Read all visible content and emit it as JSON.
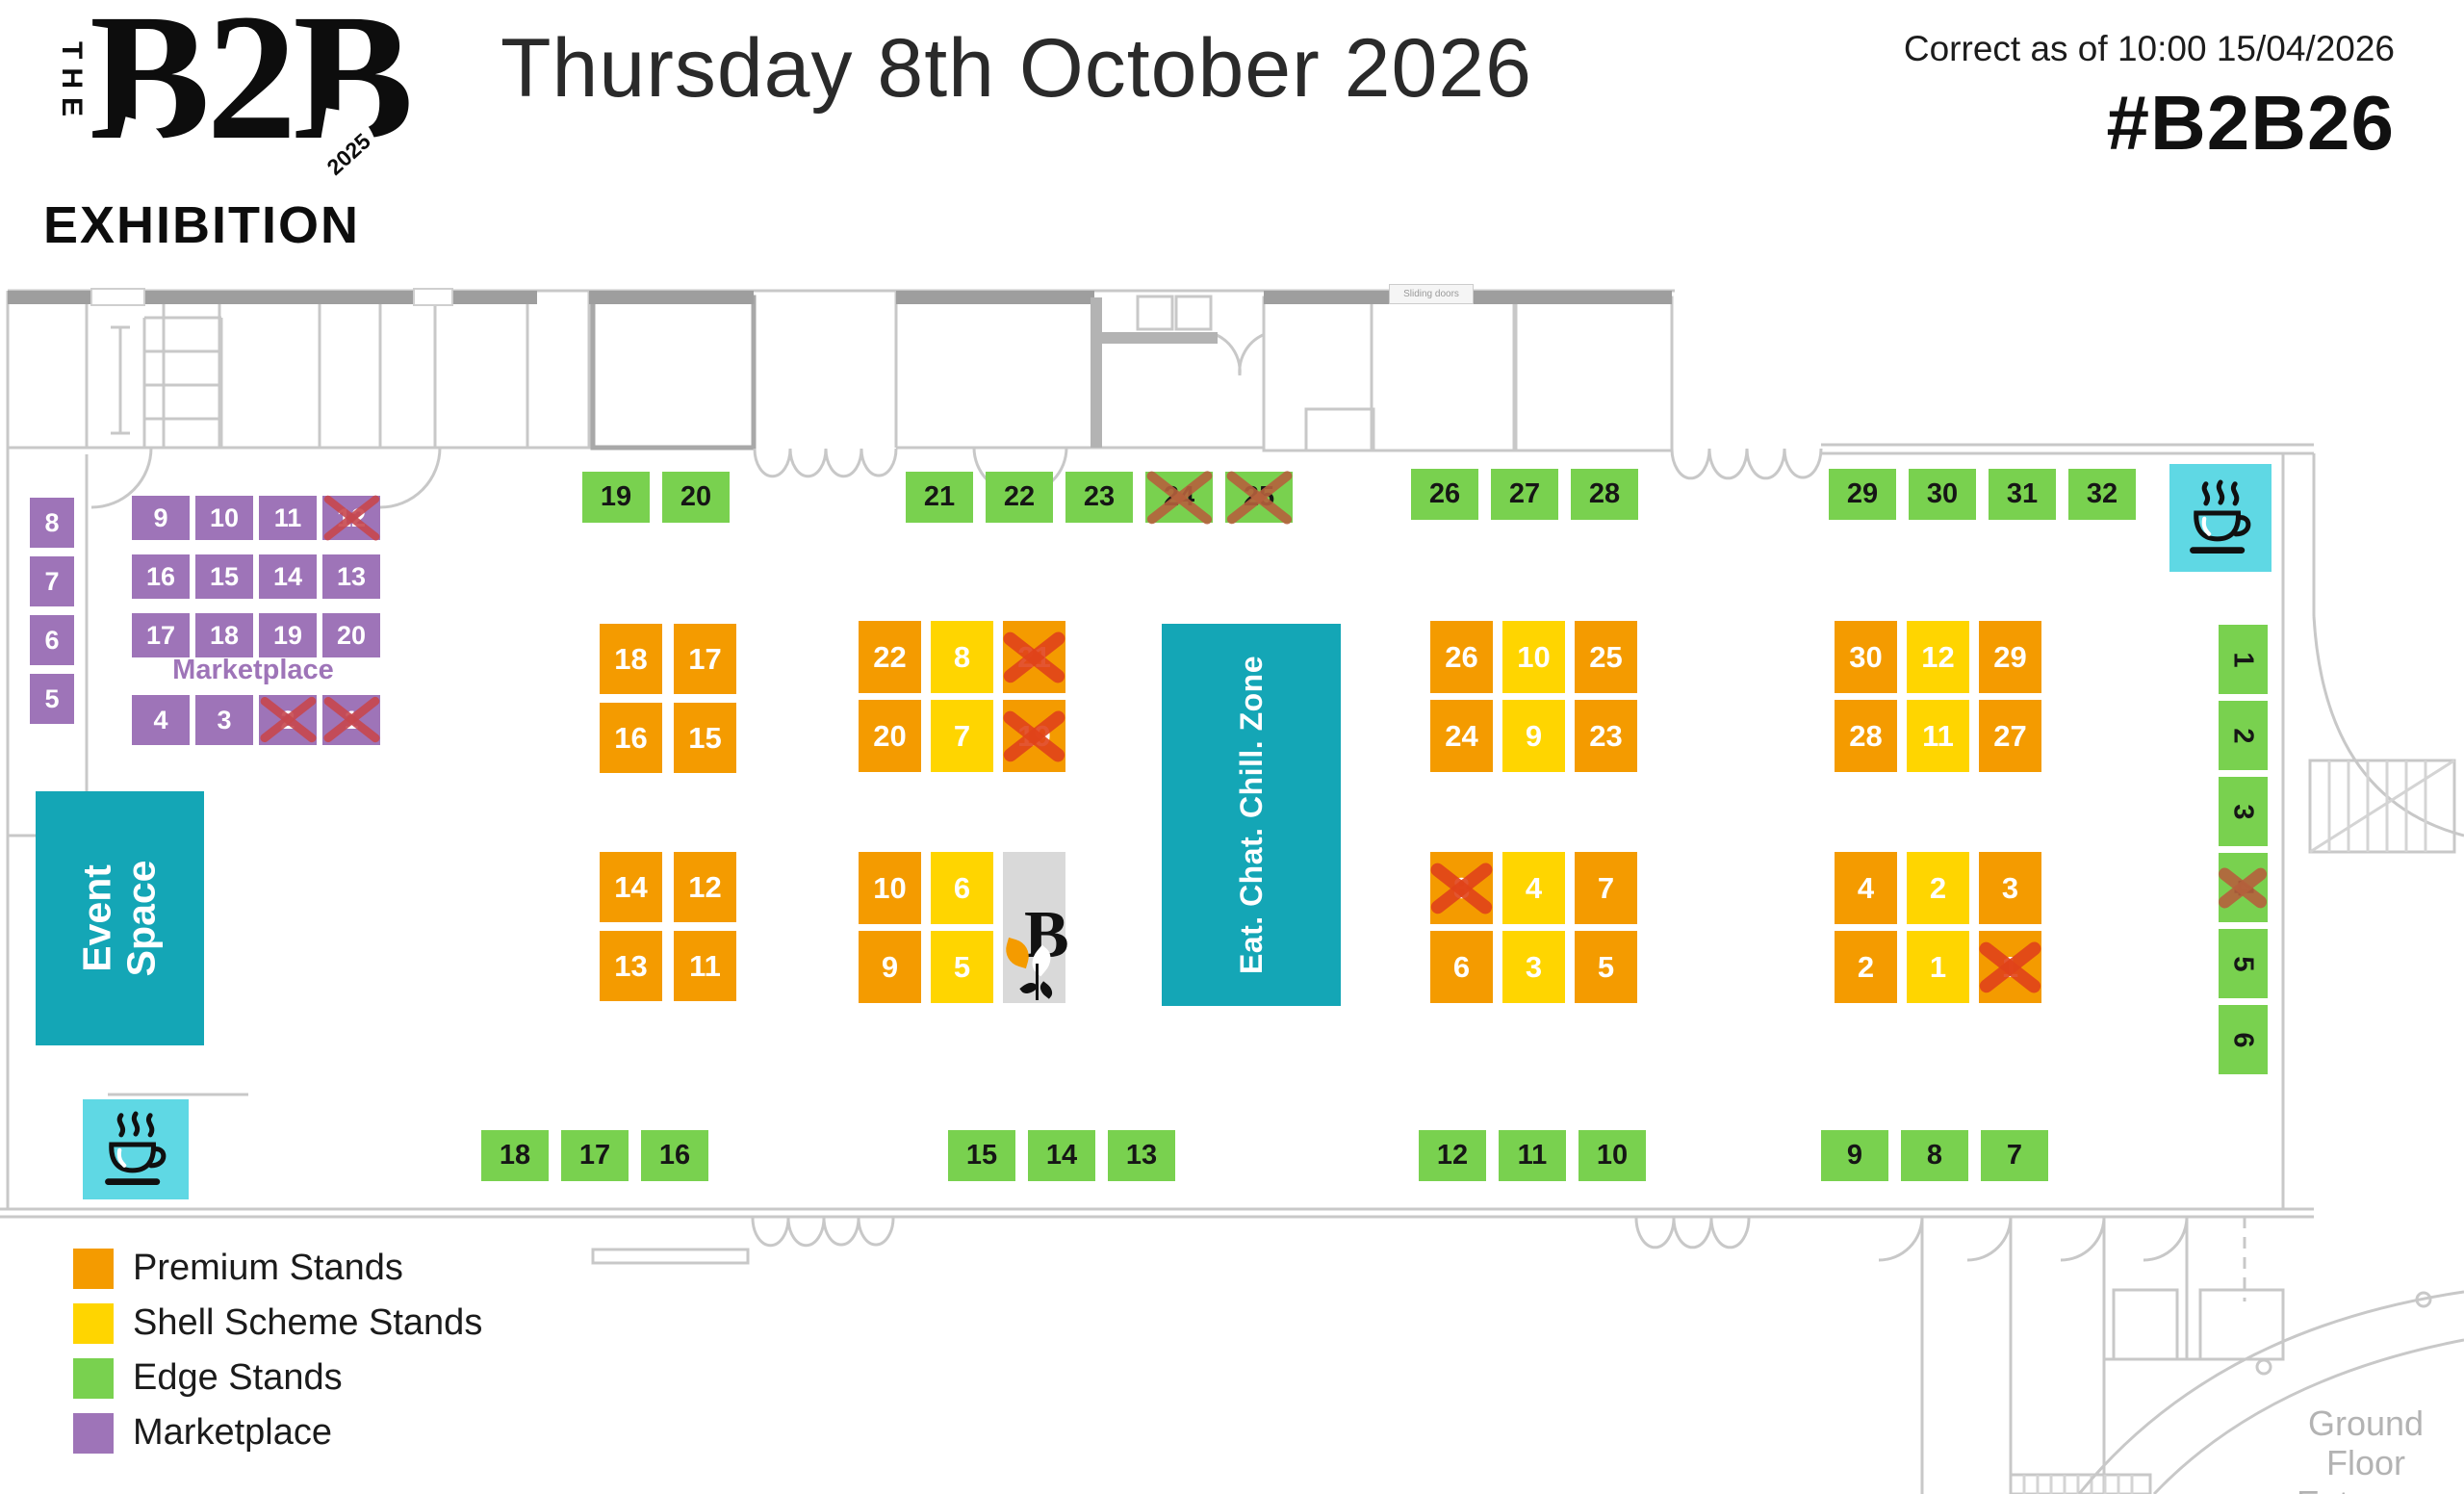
{
  "colors": {
    "premium": "#F49B00",
    "shell": "#FFD500",
    "edge": "#79D14F",
    "marketplace": "#9E74B8",
    "teal": "#14A6B6",
    "teal_light": "#5FD8E4",
    "cross_orange": "#E0421A",
    "cross_crimson": "#C7474E",
    "cross_brick": "#B5603C"
  },
  "header": {
    "logo_the": "THE",
    "logo_b2b": "B2B",
    "logo_year": "2025",
    "logo_exhibition": "EXHIBITION",
    "title": "Thursday 8th October 2026",
    "correct_as_of": "Correct as of 10:00 15/04/2026",
    "hashtag": "#B2B26"
  },
  "zones": {
    "event_space": "Event Space",
    "eat_chat_chill": "Eat. Chat. Chill. Zone",
    "marketplace_label": "Marketplace",
    "ground_floor_line1": "Ground Floor",
    "ground_floor_line2": "Entrance",
    "sliding_doors": "Sliding doors",
    "b_stand_letter": "B"
  },
  "legend": {
    "items": [
      {
        "label": "Premium Stands",
        "type": "p"
      },
      {
        "label": "Shell Scheme Stands",
        "type": "s"
      },
      {
        "label": "Edge Stands",
        "type": "e"
      },
      {
        "label": "Marketplace",
        "type": "m"
      }
    ]
  },
  "stands": {
    "marketplace_column": [
      [
        {
          "n": "8",
          "t": "m"
        }
      ],
      [
        {
          "n": "7",
          "t": "m"
        }
      ],
      [
        {
          "n": "6",
          "t": "m"
        }
      ],
      [
        {
          "n": "5",
          "t": "m"
        }
      ]
    ],
    "marketplace_grid": [
      [
        {
          "n": "9",
          "t": "m"
        },
        {
          "n": "10",
          "t": "m"
        },
        {
          "n": "11",
          "t": "m"
        },
        {
          "n": "12",
          "t": "m",
          "x": true
        }
      ],
      [
        {
          "n": "16",
          "t": "m"
        },
        {
          "n": "15",
          "t": "m"
        },
        {
          "n": "14",
          "t": "m"
        },
        {
          "n": "13",
          "t": "m"
        }
      ],
      [
        {
          "n": "17",
          "t": "m"
        },
        {
          "n": "18",
          "t": "m"
        },
        {
          "n": "19",
          "t": "m"
        },
        {
          "n": "20",
          "t": "m"
        }
      ]
    ],
    "marketplace_row4": [
      [
        {
          "n": "4",
          "t": "m"
        },
        {
          "n": "3",
          "t": "m"
        },
        {
          "n": "2",
          "t": "m",
          "x": true
        },
        {
          "n": "1",
          "t": "m",
          "x": true
        }
      ]
    ],
    "edge_top_a": [
      [
        {
          "n": "19",
          "t": "e"
        },
        {
          "n": "20",
          "t": "e"
        }
      ]
    ],
    "edge_top_b": [
      [
        {
          "n": "21",
          "t": "e"
        },
        {
          "n": "22",
          "t": "e"
        },
        {
          "n": "23",
          "t": "e"
        },
        {
          "n": "24",
          "t": "e",
          "x": true
        },
        {
          "n": "25",
          "t": "e",
          "x": true
        }
      ]
    ],
    "edge_top_c": [
      [
        {
          "n": "26",
          "t": "e"
        },
        {
          "n": "27",
          "t": "e"
        },
        {
          "n": "28",
          "t": "e"
        }
      ]
    ],
    "edge_top_d": [
      [
        {
          "n": "29",
          "t": "e"
        },
        {
          "n": "30",
          "t": "e"
        },
        {
          "n": "31",
          "t": "e"
        },
        {
          "n": "32",
          "t": "e"
        }
      ]
    ],
    "cluster_a_top": [
      [
        {
          "n": "18",
          "t": "p"
        },
        {
          "n": "17",
          "t": "p"
        }
      ],
      [
        {
          "n": "16",
          "t": "p"
        },
        {
          "n": "15",
          "t": "p"
        }
      ]
    ],
    "cluster_a_bottom": [
      [
        {
          "n": "14",
          "t": "p"
        },
        {
          "n": "12",
          "t": "p"
        }
      ],
      [
        {
          "n": "13",
          "t": "p"
        },
        {
          "n": "11",
          "t": "p"
        }
      ]
    ],
    "cluster_b_top": [
      [
        {
          "n": "22",
          "t": "p"
        },
        {
          "n": "8",
          "t": "s"
        },
        {
          "n": "21",
          "t": "p",
          "x": true
        }
      ],
      [
        {
          "n": "20",
          "t": "p"
        },
        {
          "n": "7",
          "t": "s"
        },
        {
          "n": "19",
          "t": "p",
          "x": true
        }
      ]
    ],
    "cluster_b_bottom": [
      [
        {
          "n": "10",
          "t": "p"
        },
        {
          "n": "6",
          "t": "s"
        }
      ],
      [
        {
          "n": "9",
          "t": "p"
        },
        {
          "n": "5",
          "t": "s"
        }
      ]
    ],
    "cluster_c_top": [
      [
        {
          "n": "26",
          "t": "p"
        },
        {
          "n": "10",
          "t": "s"
        },
        {
          "n": "25",
          "t": "p"
        }
      ],
      [
        {
          "n": "24",
          "t": "p"
        },
        {
          "n": "9",
          "t": "s"
        },
        {
          "n": "23",
          "t": "p"
        }
      ]
    ],
    "cluster_c_bottom": [
      [
        {
          "n": "8",
          "t": "p",
          "x": true
        },
        {
          "n": "4",
          "t": "s"
        },
        {
          "n": "7",
          "t": "p"
        }
      ],
      [
        {
          "n": "6",
          "t": "p"
        },
        {
          "n": "3",
          "t": "s"
        },
        {
          "n": "5",
          "t": "p"
        }
      ]
    ],
    "cluster_d_top": [
      [
        {
          "n": "30",
          "t": "p"
        },
        {
          "n": "12",
          "t": "s"
        },
        {
          "n": "29",
          "t": "p"
        }
      ],
      [
        {
          "n": "28",
          "t": "p"
        },
        {
          "n": "11",
          "t": "s"
        },
        {
          "n": "27",
          "t": "p"
        }
      ]
    ],
    "cluster_d_bottom": [
      [
        {
          "n": "4",
          "t": "p"
        },
        {
          "n": "2",
          "t": "s"
        },
        {
          "n": "3",
          "t": "p"
        }
      ],
      [
        {
          "n": "2",
          "t": "p"
        },
        {
          "n": "1",
          "t": "s"
        },
        {
          "n": "1",
          "t": "p",
          "x": true
        }
      ]
    ],
    "edge_right_column": [
      [
        {
          "n": "1",
          "t": "e"
        }
      ],
      [
        {
          "n": "2",
          "t": "e"
        }
      ],
      [
        {
          "n": "3",
          "t": "e"
        }
      ],
      [
        {
          "n": "4",
          "t": "e",
          "x": true
        }
      ],
      [
        {
          "n": "5",
          "t": "e"
        }
      ],
      [
        {
          "n": "6",
          "t": "e"
        }
      ]
    ],
    "edge_bottom_a": [
      [
        {
          "n": "18",
          "t": "e"
        },
        {
          "n": "17",
          "t": "e"
        },
        {
          "n": "16",
          "t": "e"
        }
      ]
    ],
    "edge_bottom_b": [
      [
        {
          "n": "15",
          "t": "e"
        },
        {
          "n": "14",
          "t": "e"
        },
        {
          "n": "13",
          "t": "e"
        }
      ]
    ],
    "edge_bottom_c": [
      [
        {
          "n": "12",
          "t": "e"
        },
        {
          "n": "11",
          "t": "e"
        },
        {
          "n": "10",
          "t": "e"
        }
      ]
    ],
    "edge_bottom_d": [
      [
        {
          "n": "9",
          "t": "e"
        },
        {
          "n": "8",
          "t": "e"
        },
        {
          "n": "7",
          "t": "e"
        }
      ]
    ]
  }
}
